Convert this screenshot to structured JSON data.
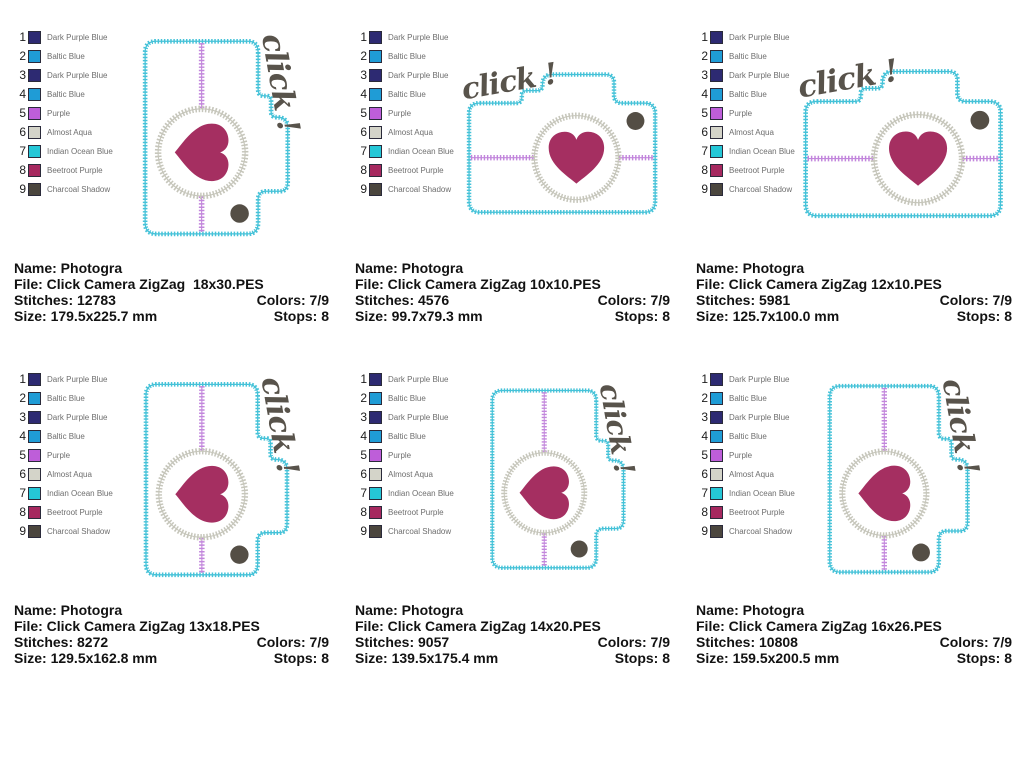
{
  "page": {
    "background": "#ffffff"
  },
  "legend": {
    "entries": [
      {
        "num": "1",
        "name": "Dark Purple Blue",
        "color": "#2d2a72"
      },
      {
        "num": "2",
        "name": "Baltic Blue",
        "color": "#1f9cd6"
      },
      {
        "num": "3",
        "name": "Dark Purple Blue",
        "color": "#2d2a72"
      },
      {
        "num": "4",
        "name": "Baltic Blue",
        "color": "#1f9cd6"
      },
      {
        "num": "5",
        "name": "Purple",
        "color": "#be5ed9"
      },
      {
        "num": "6",
        "name": "Almost Aqua",
        "color": "#d4d4c9"
      },
      {
        "num": "7",
        "name": "Indian Ocean Blue",
        "color": "#25c7d7"
      },
      {
        "num": "8",
        "name": "Beetroot Purple",
        "color": "#a6285f"
      },
      {
        "num": "9",
        "name": "Charcoal Shadow",
        "color": "#4b463e"
      }
    ]
  },
  "artwork": {
    "click_text": "click !",
    "body_fill": "#ffffff",
    "outline_color": "#45c2d8",
    "lens_color": "#c6c6bb",
    "stripe_color": "#c286dc",
    "heart_color": "#a52f61",
    "flash_color": "#544e45",
    "click_color": "#58534b"
  },
  "designs": [
    {
      "name_line": "Name: Photogra",
      "file_line": "File: Click Camera ZigZag  18x30.PES",
      "stitches_line": "Stitches: 12783",
      "colors_line": "Colors: 7/9",
      "size_line": "Size: 179.5x225.7 mm",
      "stops_line": "Stops: 8"
    },
    {
      "name_line": "Name: Photogra",
      "file_line": "File: Click Camera ZigZag 10x10.PES",
      "stitches_line": "Stitches: 4576",
      "colors_line": "Colors: 7/9",
      "size_line": "Size: 99.7x79.3 mm",
      "stops_line": "Stops: 8"
    },
    {
      "name_line": "Name: Photogra",
      "file_line": "File: Click Camera ZigZag 12x10.PES",
      "stitches_line": "Stitches: 5981",
      "colors_line": "Colors: 7/9",
      "size_line": "Size: 125.7x100.0 mm",
      "stops_line": "Stops: 8"
    },
    {
      "name_line": "Name: Photogra",
      "file_line": "File: Click Camera ZigZag 13x18.PES",
      "stitches_line": "Stitches: 8272",
      "colors_line": "Colors: 7/9",
      "size_line": "Size: 129.5x162.8 mm",
      "stops_line": "Stops: 8"
    },
    {
      "name_line": "Name: Photogra",
      "file_line": "File: Click Camera ZigZag 14x20.PES",
      "stitches_line": "Stitches: 9057",
      "colors_line": "Colors: 7/9",
      "size_line": "Size: 139.5x175.4 mm",
      "stops_line": "Stops: 8"
    },
    {
      "name_line": "Name: Photogra",
      "file_line": "File: Click Camera ZigZag 16x26.PES",
      "stitches_line": "Stitches: 10808",
      "colors_line": "Colors: 7/9",
      "size_line": "Size: 159.5x200.5 mm",
      "stops_line": "Stops: 8"
    }
  ]
}
